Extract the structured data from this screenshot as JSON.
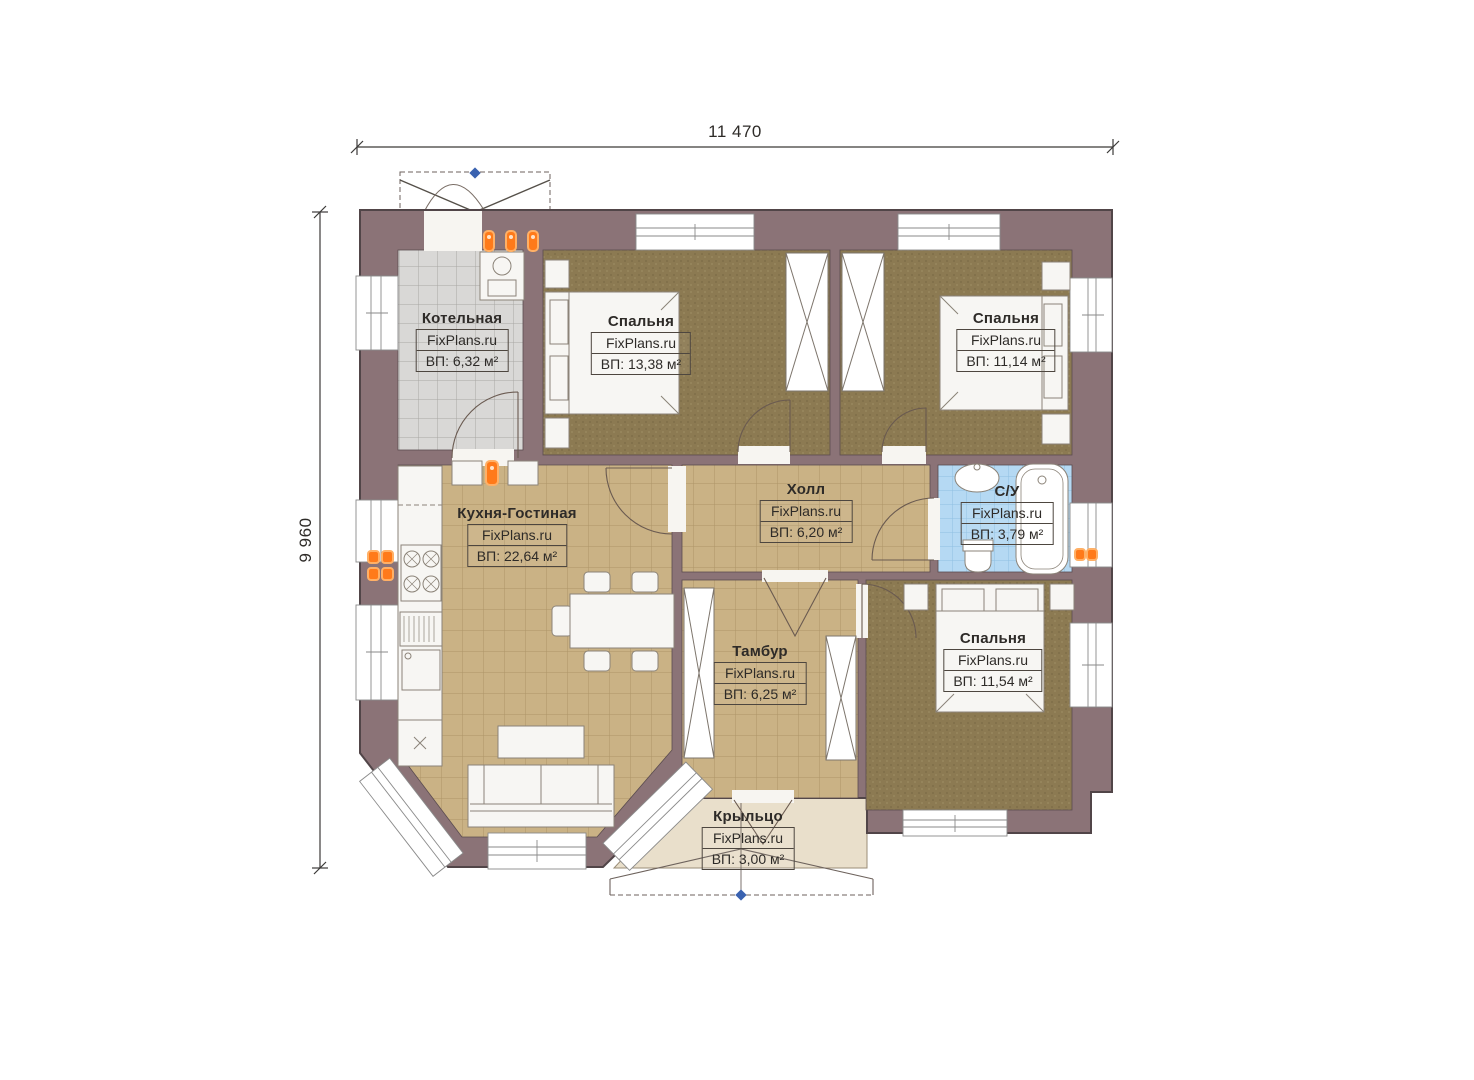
{
  "plan": {
    "dim_width_label": "11 470",
    "dim_height_label": "9 960"
  },
  "rooms": [
    {
      "name": "Котельная",
      "brand": "FixPlans.ru",
      "area": "ВП: 6,32 м²"
    },
    {
      "name": "Спальня",
      "brand": "FixPlans.ru",
      "area": "ВП: 13,38 м²"
    },
    {
      "name": "Спальня",
      "brand": "FixPlans.ru",
      "area": "ВП: 11,14 м²"
    },
    {
      "name": "Кухня-Гостиная",
      "brand": "FixPlans.ru",
      "area": "ВП: 22,64 м²"
    },
    {
      "name": "Холл",
      "brand": "FixPlans.ru",
      "area": "ВП: 6,20 м²"
    },
    {
      "name": "С/У",
      "brand": "FixPlans.ru",
      "area": "ВП: 3,79 м²"
    },
    {
      "name": "Тамбур",
      "brand": "FixPlans.ru",
      "area": "ВП: 6,25 м²"
    },
    {
      "name": "Спальня",
      "brand": "FixPlans.ru",
      "area": "ВП: 11,54 м²"
    },
    {
      "name": "Крыльцо",
      "brand": "FixPlans.ru",
      "area": "ВП: 3,00 м²"
    }
  ],
  "colors": {
    "wall": "#8b7377",
    "floor_tile_tan": "#cab285",
    "floor_carpet": "#8c7a52",
    "floor_boiler_gray": "#d9d8d6",
    "floor_bath_blue": "#b5d9f3",
    "porch_beige": "#e9dfcb",
    "vent_orange": "#ff7a1a",
    "marker_blue": "#3a62b0"
  }
}
